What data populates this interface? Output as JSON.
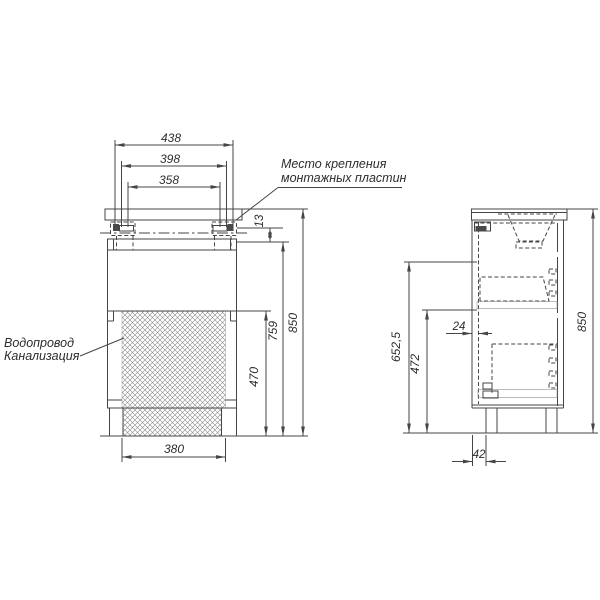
{
  "front_view": {
    "width_dims": [
      "438",
      "398",
      "358"
    ],
    "plate_offset_dim": "13",
    "height_dims": [
      "470",
      "759",
      "850"
    ],
    "base_width_dim": "380",
    "mounting_label": {
      "line1": "Место крепления",
      "line2": "монтажных пластин"
    },
    "plumbing_label": {
      "line1": "Водопровод",
      "line2": "Канализация"
    }
  },
  "side_view": {
    "carcass_height_dim": "652,5",
    "lower_height_dim": "472",
    "total_height_dim": "850",
    "back_offset_dim": "24",
    "leg_offset_dim": "42"
  },
  "colors": {
    "background": "#ffffff",
    "line": "#454545",
    "text": "#2d2d2d",
    "hatch": "#8a8a8a"
  }
}
